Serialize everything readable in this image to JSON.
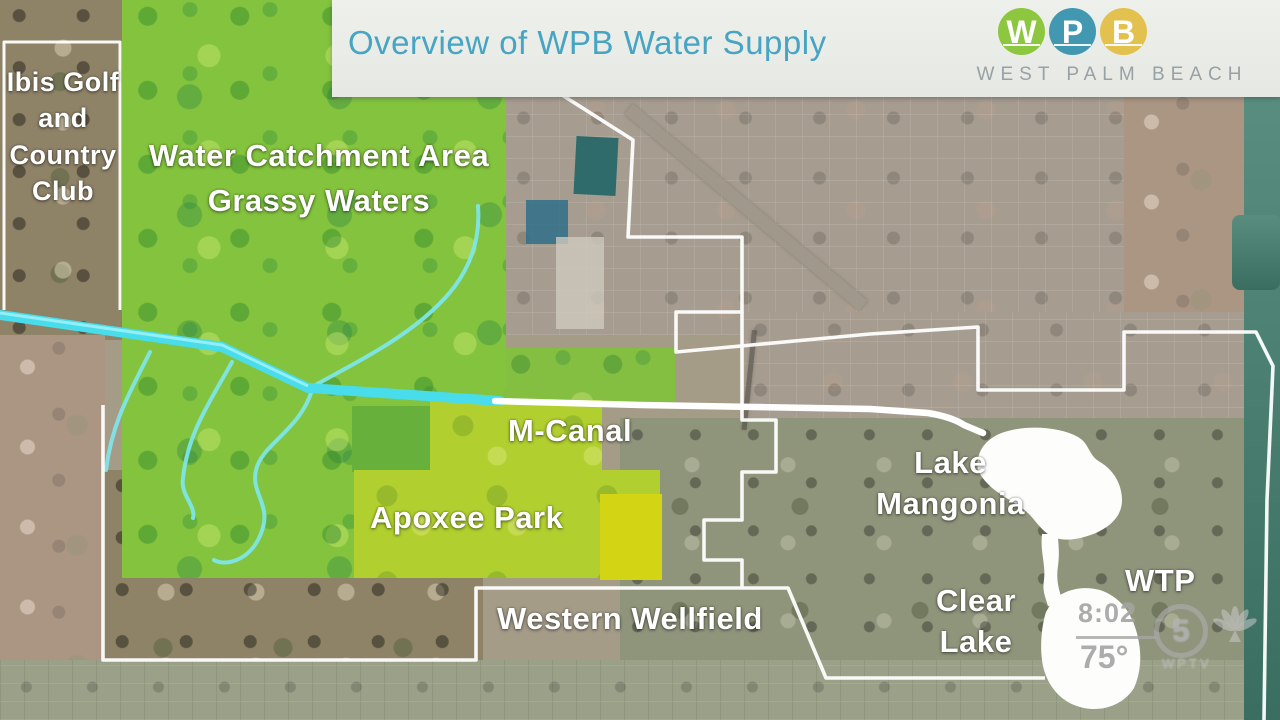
{
  "header": {
    "title": "Overview of WPB Water Supply",
    "brand": {
      "letters": [
        "W",
        "P",
        "B"
      ],
      "name": "WEST PALM BEACH",
      "circle_colors": [
        "#8dc63f",
        "#4198b0",
        "#e3c14f"
      ]
    }
  },
  "map": {
    "labels": {
      "ibis": "Ibis Golf\nand\nCountry\nClub",
      "catchment": "Water Catchment Area\nGrassy Waters",
      "m_canal": "M-Canal",
      "apoxee": "Apoxee Park",
      "western_wellfield": "Western Wellfield",
      "lake_mangonia": "Lake\nMangonia",
      "clear_lake": "Clear\nLake",
      "wtp": "WTP"
    },
    "feature_colors": {
      "canal": "#49dcea",
      "piped_canal": "#ffffff",
      "city_boundary": "#ffffff",
      "catchment_area": "#83c33d",
      "apoxee_park": "#b1d02f",
      "wellfield_patch": "#d3d414",
      "lakes": "#fdfdfb",
      "coastal_water": "#417d6e",
      "title_text": "#47a5c3"
    }
  },
  "news_bug": {
    "time": "8:02",
    "temperature": "75°",
    "channel_number": "5",
    "station": "WPTV"
  }
}
